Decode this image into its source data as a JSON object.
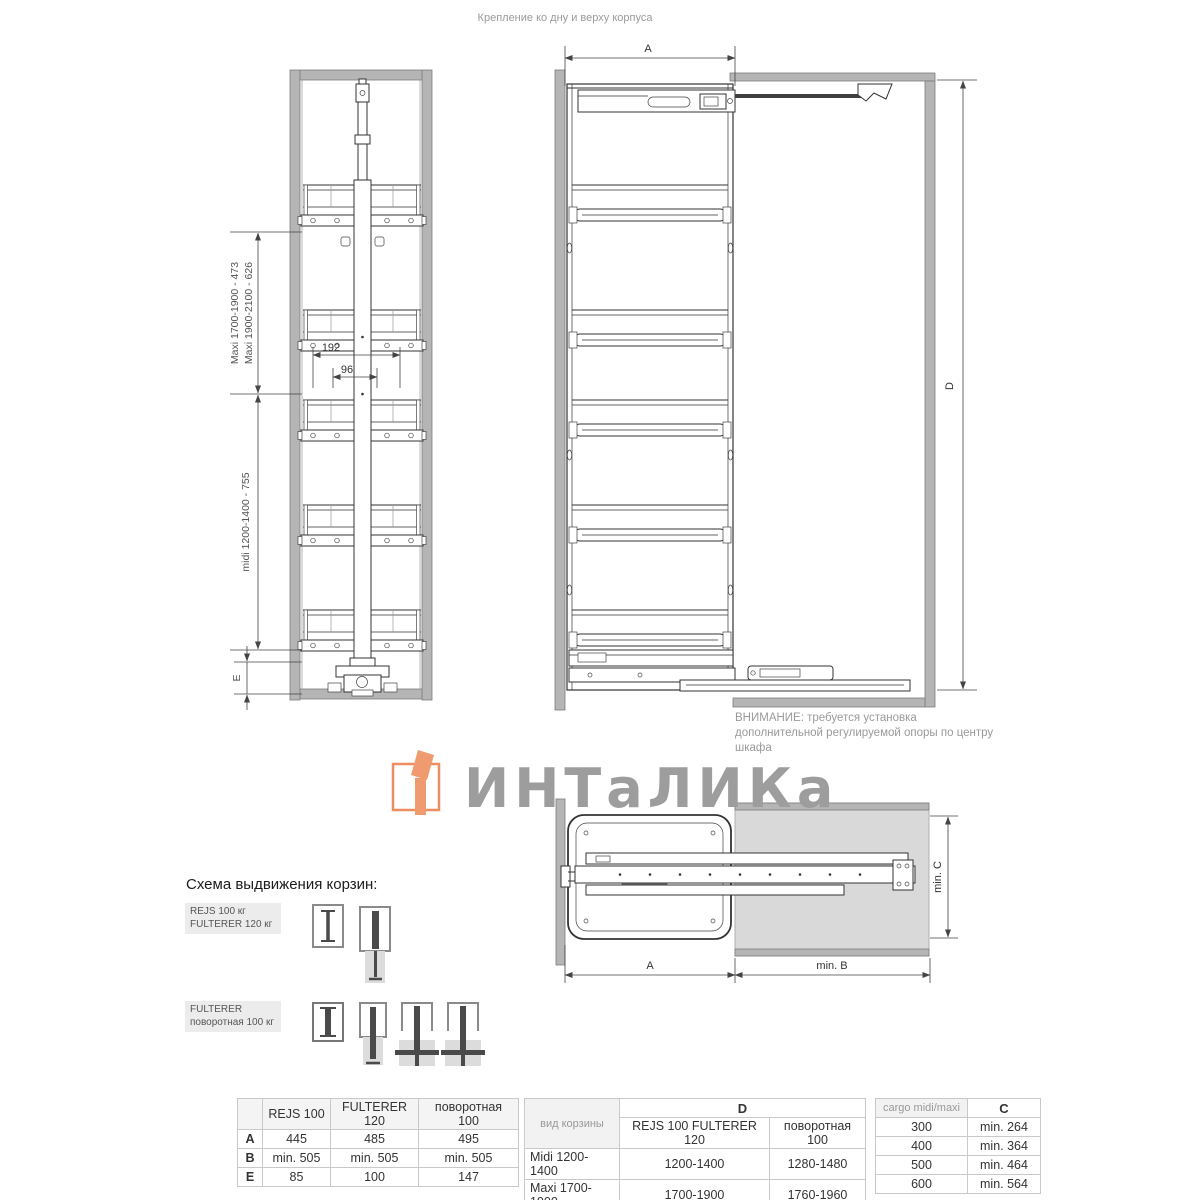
{
  "header": {
    "note": "Крепление ко дну и верху корпуса"
  },
  "front_view": {
    "dim_maxi1": "Maxi 1700-1900 - 473",
    "dim_maxi2": "Maxi 1900-2100 - 626",
    "dim_midi": "midi 1200-1400 - 755",
    "dim_e": "E",
    "dim_192": "192",
    "dim_96": "96"
  },
  "side_view": {
    "dim_a": "A",
    "dim_d": "D",
    "warning": "ВНИМАНИЕ: требуется установка дополнительной регулируемой опоры по центру шкафа"
  },
  "logo": {
    "text": "ИНТаЛИКа",
    "accent_orange": "#EF8E63",
    "gray": "#9D9D9D"
  },
  "top_view": {
    "dim_a": "A",
    "dim_min_b": "min. B",
    "dim_min_c": "min. C"
  },
  "schema": {
    "heading": "Схема выдвижения корзин:",
    "row1_label_line1": "REJS 100 кг",
    "row1_label_line2": "FULTERER 120 кг",
    "row2_label_line1": "FULTERER",
    "row2_label_line2": "поворотная 100 кг"
  },
  "tables": {
    "t1": {
      "headers": [
        "",
        "REJS 100",
        "FULTERER 120",
        "поворотная 100"
      ],
      "rows": [
        [
          "A",
          "445",
          "485",
          "495"
        ],
        [
          "B",
          "min. 505",
          "min. 505",
          "min. 505"
        ],
        [
          "E",
          "85",
          "100",
          "147"
        ]
      ]
    },
    "t2": {
      "col_header": "вид корзины",
      "span_header": "D",
      "sub_headers": [
        "REJS 100  FULTERER 120",
        "поворотная 100"
      ],
      "rows": [
        [
          "Midi 1200-1400",
          "1200-1400",
          "1280-1480"
        ],
        [
          "Maxi 1700-1900",
          "1700-1900",
          "1760-1960"
        ],
        [
          "Maxi 1900-2100",
          "1900-2100",
          "1960-2160"
        ]
      ]
    },
    "t3": {
      "headers": [
        "cargo midi/maxi",
        "C"
      ],
      "rows": [
        [
          "300",
          "min. 264"
        ],
        [
          "400",
          "min. 364"
        ],
        [
          "500",
          "min. 464"
        ],
        [
          "600",
          "min. 564"
        ]
      ]
    }
  },
  "colors": {
    "panel_gray": "#B5B5B5",
    "note_gray": "#9A9A9A",
    "line": "#333333"
  }
}
